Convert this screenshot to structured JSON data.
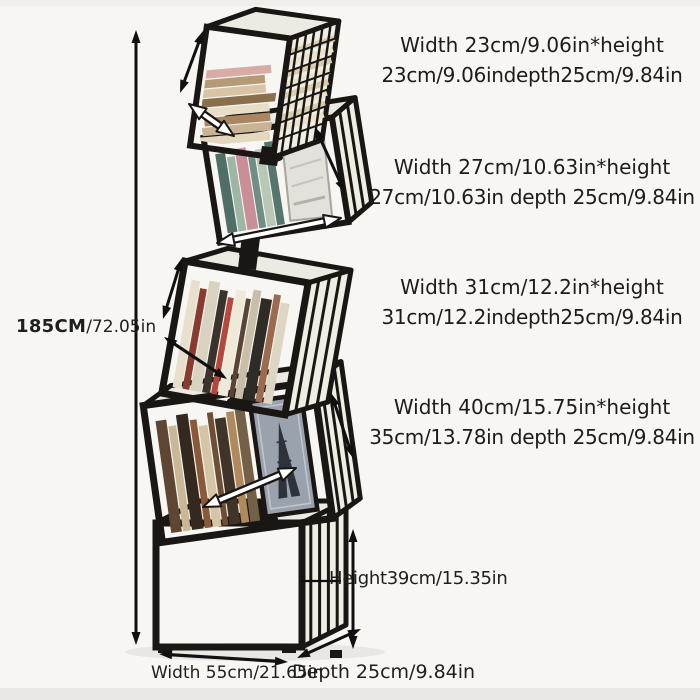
{
  "image": {
    "background": "#f7f6f2",
    "description_labels_color": "#1c1c1c"
  },
  "annotations": {
    "total_height": {
      "value_cm": "185CM",
      "value_in": "/72.05in"
    },
    "tiers": [
      {
        "name": "tier-1-top",
        "line1": "Width 23cm/9.06in*height",
        "line2": "23cm/9.06indepth25cm/9.84in"
      },
      {
        "name": "tier-2",
        "line1": "Width 27cm/10.63in*height",
        "line2": "27cm/10.63in depth 25cm/9.84in"
      },
      {
        "name": "tier-3",
        "line1": "Width 31cm/12.2in*height",
        "line2": "31cm/12.2indepth25cm/9.84in"
      },
      {
        "name": "tier-4",
        "line1": "Width 40cm/15.75in*height",
        "line2": "35cm/13.78in depth 25cm/9.84in"
      }
    ],
    "base": {
      "height_label": "Height39cm/15.35in",
      "width_label": "Width 55cm/21.65in",
      "depth_label": "Depth 25cm/9.84in"
    }
  },
  "art": {
    "frame_color": "#1a1613",
    "arrow_color": "#101010",
    "top_face_color": "#edeae3",
    "side_face_color": "#f0ede5",
    "shadow_color": "rgba(0,0,0,0.06)",
    "palettes": {
      "tier1_books": [
        "#e3d7bd",
        "#c9b394",
        "#a8865f",
        "#e8ddc6",
        "#8a6f4d",
        "#d8c3a4",
        "#b59a76",
        "#d8aca4"
      ],
      "tier2_books": [
        "#4f6e66",
        "#9fb5a6",
        "#c98f98",
        "#6f8f86",
        "#b9c8b4",
        "#56756c",
        "#cfd5c8",
        "#87a095"
      ],
      "tier3_books": [
        "#e8e0cc",
        "#8a3b2f",
        "#d9d2c0",
        "#3a332b",
        "#b5483c",
        "#efe9d8",
        "#5a4436",
        "#c9bfa8",
        "#2f2b26",
        "#9c6b4f",
        "#ddd6c4",
        "#7a4a3a"
      ],
      "tier4_books": [
        "#5f4632",
        "#c9b795",
        "#33291e",
        "#8a5a38",
        "#d5c5a4",
        "#6e4f35",
        "#403428",
        "#b08a5c",
        "#746046",
        "#2b241c"
      ],
      "base_books": [
        "#6b4a2f",
        "#d8c7a5",
        "#2e2820",
        "#94613c",
        "#c8b089",
        "#4a3a2a",
        "#a67c4e",
        "#30291f",
        "#c2a274",
        "#5d4a35",
        "#8a5c3b",
        "#d2c09c",
        "#3d332a",
        "#b08e62",
        "#715c41",
        "#c9b493",
        "#26201a",
        "#8f7350"
      ],
      "poster_bg": "#9aa2ae",
      "poster_ink": "#2e323a",
      "picture_bg": "#e2e1dc",
      "stripe_a": "#ece3cb",
      "stripe_b": "#d9cdb0"
    }
  }
}
